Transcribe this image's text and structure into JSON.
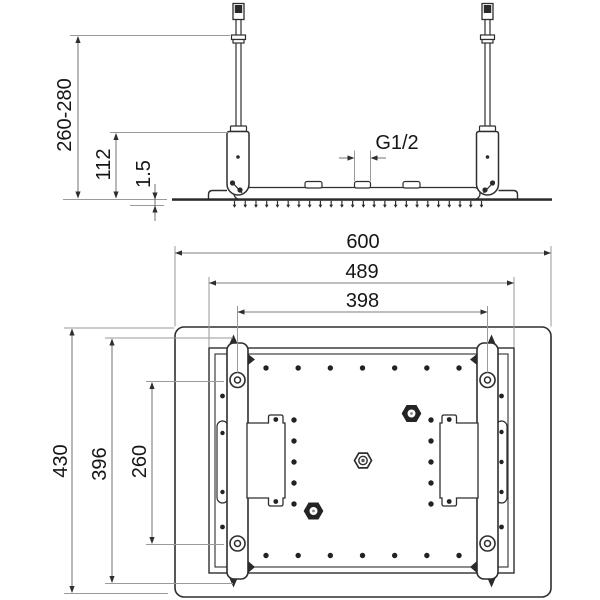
{
  "side_view": {
    "dimensions": {
      "mounting_height_range": "260-280",
      "bracket_drop": "112",
      "panel_gap": "1.5",
      "inlet_thread": "G1/2"
    }
  },
  "plan_view": {
    "dimensions": {
      "overall_width": "600",
      "panel_width": "489",
      "rod_spacing": "398",
      "overall_depth": "430",
      "rail_span": "396",
      "bolt_spacing": "260"
    }
  },
  "colors": {
    "drawing_line": "#2e2e2e",
    "dimension_line": "#7d7d7d",
    "extension_line": "#9a9a9a",
    "label_text": "#161616",
    "background": "#ffffff"
  }
}
